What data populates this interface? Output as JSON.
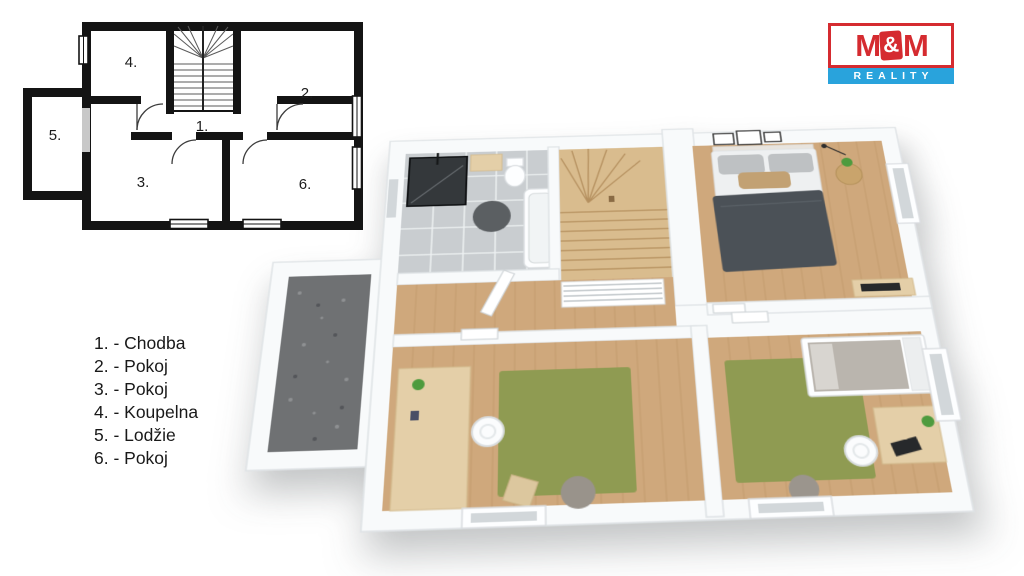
{
  "legend": {
    "items": [
      "1. - Chodba",
      "2. - Pokoj",
      "3. - Pokoj",
      "4. - Koupelna",
      "5. - Lodžie",
      "6. - Pokoj"
    ]
  },
  "floorplan2d": {
    "room_labels": [
      "1.",
      "2.",
      "3.",
      "4.",
      "5.",
      "6."
    ]
  },
  "logo": {
    "m_left": "M",
    "ampersand": "&",
    "m_right": "M",
    "reality": "REALITY"
  },
  "colors": {
    "plan_black": "#141414",
    "logo_red": "#d52b30",
    "logo_blue": "#29a3dc",
    "wall_white": "#f8fafb",
    "wood_floor": "#cfa87c",
    "wood_plank_line": "#b5905f",
    "stair_wood": "#d9bc8e",
    "tile_grey": "#c9cdd0",
    "loggia_floor": "#6f7173",
    "rug_green": "#8f9b52",
    "duvet_dark": "#4b5157",
    "pillow_beige": "#c2a173",
    "desk_wood": "#e4cfa8",
    "shower_dark": "#34383b"
  }
}
